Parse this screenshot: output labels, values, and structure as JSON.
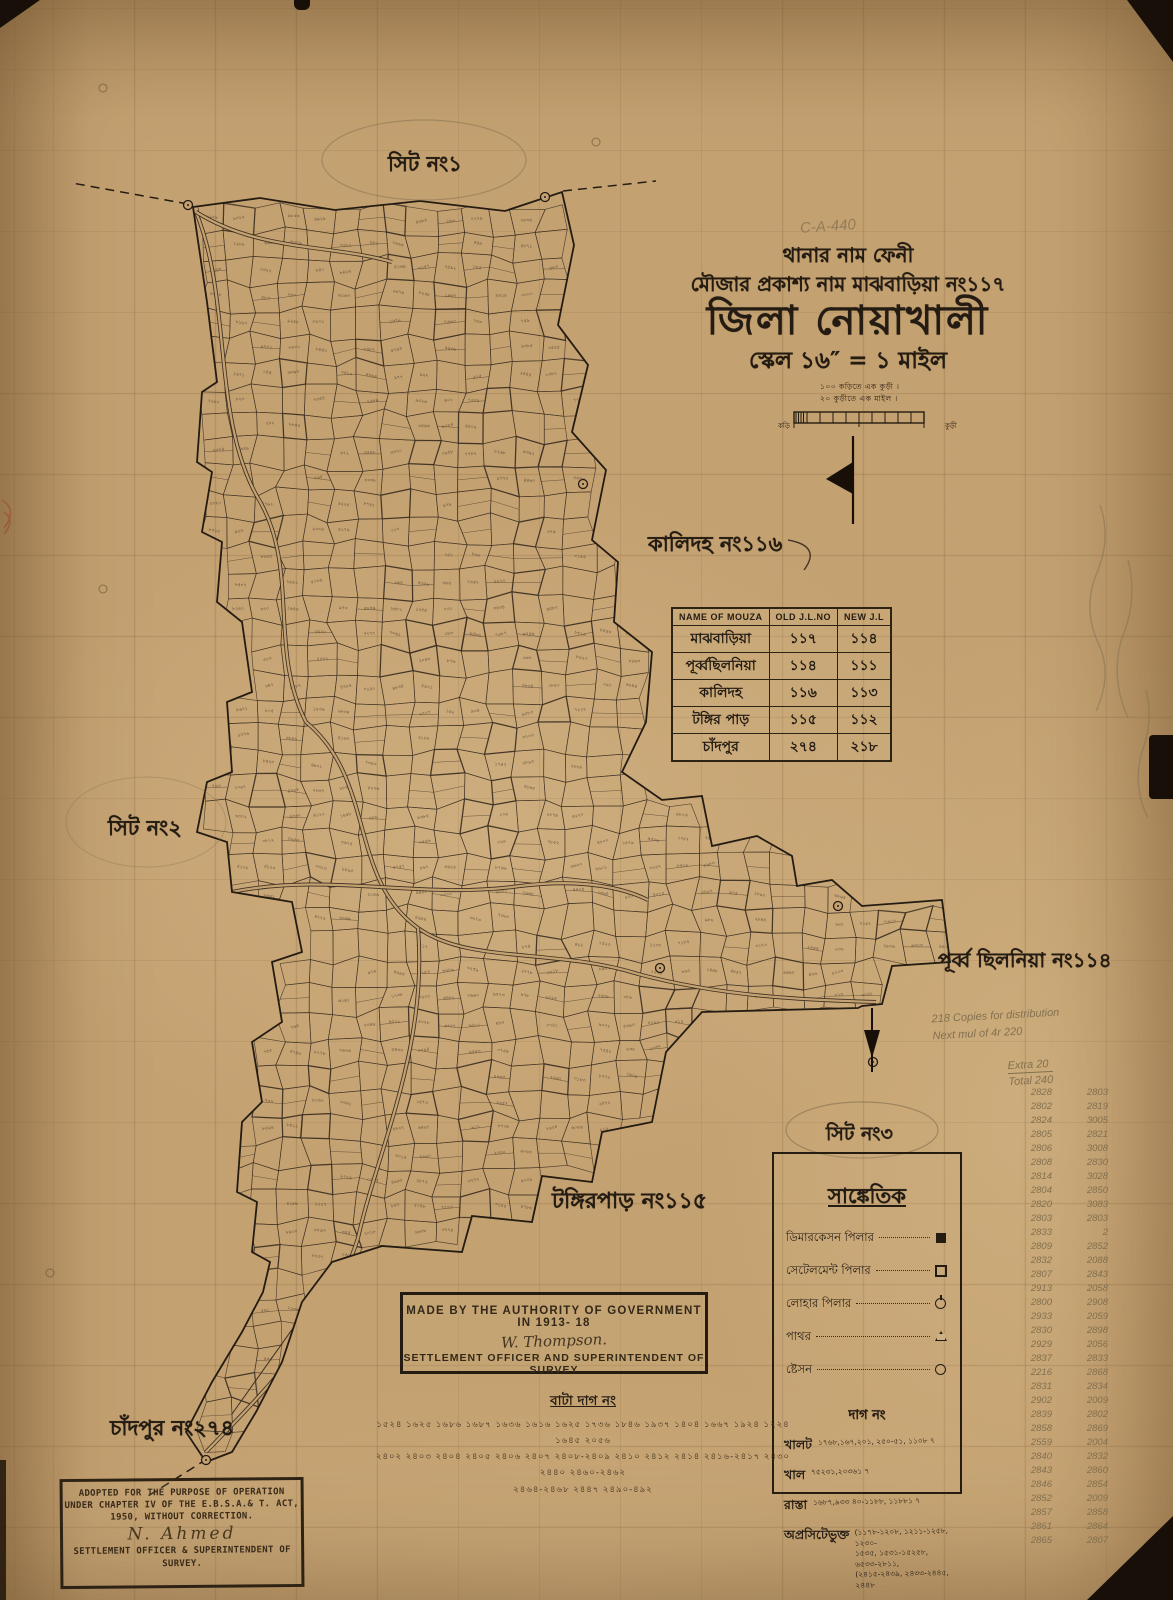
{
  "header": {
    "line1": "থানার নাম ফেনী",
    "line2": "মৌজার প্রকাশ্য নাম মাঝবাড়িয়া নং১১৭",
    "line3": "জিলা নোয়াখালী",
    "line4": "স্কেল ১৬″ = ১ মাইল",
    "pencil_note": "C-A-440"
  },
  "scale_bar": {
    "note1": "১০০ কড়িতে এক কুড়ী ।",
    "note2": "২০ কুড়ীতে এক মাইল ।",
    "left_label": "কড়ি",
    "right_label": "কুড়ী"
  },
  "jl_table": {
    "headers": [
      "NAME OF MOUZA",
      "OLD J.L.NO",
      "NEW J.L"
    ],
    "rows": [
      [
        "মাঝবাড়িয়া",
        "১১৭",
        "১১৪"
      ],
      [
        "পূর্ব্বছিলনিয়া",
        "১১৪",
        "১১১"
      ],
      [
        "কালিদহ",
        "১১৬",
        "১১৩"
      ],
      [
        "টঙ্গির পাড়",
        "১১৫",
        "১১২"
      ],
      [
        "চাঁদপুর",
        "২৭৪",
        "২১৮"
      ]
    ]
  },
  "map_labels": {
    "sheet1": "সিট নং১",
    "sheet2": "সিট নং২",
    "sheet3": "সিট নং৩",
    "kalidaha": "কালিদহ নং১১৬",
    "purba_chhilonia": "পূর্ব্ব ছিলনিয়া নং১১৪",
    "tangirpar": "টঙ্গিরপাড় নং১১৫",
    "chandpur": "চাঁদপুর নং২৭৪"
  },
  "legend": {
    "title": "সাঙ্কেতিক",
    "items": [
      {
        "label": "ডিমারকেসন পিলার",
        "symbol": "filled-square"
      },
      {
        "label": "সেটেলমেন্ট পিলার",
        "symbol": "open-square"
      },
      {
        "label": "লোহার পিলার",
        "symbol": "iron-pillar-circle"
      },
      {
        "label": "পাথর",
        "symbol": "triangle"
      },
      {
        "label": "ষ্টেসন",
        "symbol": "circle"
      }
    ],
    "dag_title": "দাগ নং",
    "dag_rows": [
      {
        "label": "খালট",
        "value": "১৭৬৮,১৬৭,২০১, ২৫০-৫১, ১১০৮ ৭"
      },
      {
        "label": "খাল",
        "value": "৭৫২৩১,২০৩৬১ ৭"
      },
      {
        "label": "রাস্তা",
        "value": "১৬৮৭,৯৩৩ ৪০-১১৮৮, ১১৮৮১ ৭"
      },
      {
        "label": "অপ্রসিটেভুক্ত",
        "value": "(১১৭৮-১২০৮, ১২১১-১২৫৮, ১২৩০-\n১৫৩৫, ১৫৩১-১৫২৫৮, ৬৫৩৩-২৮১১,\n(২৪১৫-২৪৩৯, ২৪৩৩-২৪৪৫,\n২৪৪৮"
      }
    ]
  },
  "made_by_box": {
    "line1": "MADE BY THE AUTHORITY OF GOVERNMENT IN  1913-  18",
    "signature": "W. Thompson.",
    "line2": "SETTLEMENT  OFFICER AND SUPERINTENDENT OF SURVEY"
  },
  "bata_dag": {
    "title": "বাটা দাগ নং",
    "rows": "১৫২৪  ১৬২৫  ১৬৮৬  ১৬৮৭  ১৬৩৬  ১৬১৬  ১৬২৫  ১৭৩৬  ১৮৪৬  ১৯৩৭  ১৪০৪  ১৬৬৭ ১৯২৪   ১২২৪  ১৬৪৫  ২০৫৬\n২৪০২  ২৪০৩  ২৪০৪  ২৪০৫  ২৪০৬  ২৪০৭  ২৪০৮-২৪০৯  ২৪১০  ২৪১২  ২৪১৪  ২৪১৬-২৪১৭  ২৪৩০  ২৪৪০  ২৪৬০-২৪৬২\n২৪৬৪-২৪৬৮   ২৪৪৭   ২৪৯০-৪৯২"
  },
  "stamp_box": {
    "line1": "ADOPTED FOR THE PURPOSE OF OPERATION",
    "line2": "UNDER CHAPTER IV OF THE E.B.S.A.& T. ACT,",
    "line3": "1950, WITHOUT CORRECTION.",
    "signature": "N. Ahmed",
    "line4": "SETTLEMENT OFFICER & SUPERINTENDENT OF",
    "line5": "SURVEY."
  },
  "pencil_notes": {
    "distribution": "218 Copies for distribution\nNext mul of 4r 220",
    "extra": "Extra 20",
    "total": "Total 240",
    "tally_left": "2828\n2802\n2824\n2805\n2806\n2808\n2814\n2804\n2820\n2803\n2833\n2809\n2832\n2807\n2913\n2800\n2933\n2830\n2929\n2837\n2216\n2831\n2902\n2839\n2858\n2559\n2840\n2843\n2846\n2852\n2857\n2861\n2865",
    "tally_right": "2803\n2819\n3005\n2821\n3008\n2830\n3028\n2850\n3083\n2803\n2\n2852\n2088\n2843\n2058\n2908\n2059\n2898\n2056\n2833\n2868\n2834\n2009\n2802\n2869\n2004\n2832\n2860\n2854\n2009\n2858\n2864\n2807"
  },
  "colors": {
    "paper": "#c4a171",
    "ink": "#241c12",
    "map_ink": "#3d3022",
    "pencil": "#82704f"
  }
}
